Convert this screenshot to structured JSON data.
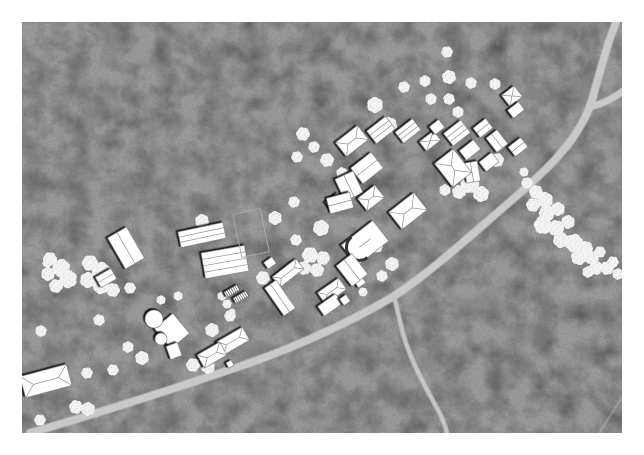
{
  "figure": {
    "kind": "architectural-site-plan",
    "page": {
      "width": 644,
      "height": 455,
      "margin": 22,
      "margin_color": "#ffffff"
    },
    "map": {
      "x": 22,
      "y": 22,
      "width": 600,
      "height": 411,
      "base_color": "#333333",
      "mottle_color": "#6b6b6b"
    }
  },
  "palette": {
    "road": "#c9c9c9",
    "road_spur": "#c6c6c6",
    "path_faint": "#bdbdbd",
    "building_fill": "#ffffff",
    "building_stroke": "#6e6e6e",
    "roof_line": "#8f8f8f",
    "shadow": "#000000",
    "tree_fill": "#f3f3f3",
    "tree_speckle": "#d8d8d8",
    "plot_outline": "#aaaaaa"
  },
  "roads": {
    "main": {
      "d": "M 616,22 C 606,48 600,72 592,100 C 580,140 545,172 505,206 C 468,238 428,274 394,296 C 356,319 300,346 238,367 C 176,388 95,414 30,433",
      "width": 8
    },
    "fork": {
      "d": "M 594,106 C 604,103 614,98 623,91",
      "width": 7
    },
    "spur": {
      "d": "M 394,296 C 399,314 401,332 410,354 C 419,377 432,398 441,416 C 444,423 446,428 447,433",
      "width": 4.5
    },
    "faint": {
      "d": "M 623,396 L 599,433",
      "width": 1.5,
      "opacity": 0.55
    }
  },
  "trees": [
    [
      303,
      134,
      6
    ],
    [
      314,
      147,
      5
    ],
    [
      297,
      157,
      5
    ],
    [
      327,
      160,
      6
    ],
    [
      342,
      173,
      5
    ],
    [
      375,
      105,
      7
    ],
    [
      389,
      125,
      7
    ],
    [
      404,
      87,
      5
    ],
    [
      425,
      81,
      5
    ],
    [
      449,
      77,
      6
    ],
    [
      471,
      83,
      5
    ],
    [
      495,
      84,
      5
    ],
    [
      431,
      99,
      5
    ],
    [
      449,
      99,
      5
    ],
    [
      458,
      112,
      5
    ],
    [
      404,
      135,
      5
    ],
    [
      447,
      52,
      5
    ],
    [
      294,
      202,
      5
    ],
    [
      50,
      259,
      6
    ],
    [
      61,
      268,
      8
    ],
    [
      48,
      274,
      6
    ],
    [
      68,
      279,
      8
    ],
    [
      56,
      286,
      6
    ],
    [
      90,
      263,
      7
    ],
    [
      101,
      271,
      8
    ],
    [
      88,
      280,
      7
    ],
    [
      101,
      286,
      7
    ],
    [
      113,
      290,
      6
    ],
    [
      130,
      288,
      5
    ],
    [
      47,
      263,
      4
    ],
    [
      161,
      300,
      4
    ],
    [
      178,
      296,
      4
    ],
    [
      99,
      320,
      5
    ],
    [
      41,
      331,
      5
    ],
    [
      128,
      347,
      5
    ],
    [
      202,
      221,
      6
    ],
    [
      275,
      218,
      6
    ],
    [
      321,
      228,
      7
    ],
    [
      296,
      240,
      5
    ],
    [
      310,
      255,
      7
    ],
    [
      323,
      258,
      6
    ],
    [
      304,
      268,
      6
    ],
    [
      317,
      270,
      6
    ],
    [
      263,
      278,
      6
    ],
    [
      377,
      247,
      5
    ],
    [
      392,
      264,
      6
    ],
    [
      382,
      276,
      5
    ],
    [
      363,
      292,
      4
    ],
    [
      222,
      296,
      4
    ],
    [
      227,
      304,
      4
    ],
    [
      232,
      312,
      3
    ],
    [
      470,
      184,
      8
    ],
    [
      481,
      194,
      7
    ],
    [
      459,
      192,
      6
    ],
    [
      497,
      160,
      6
    ],
    [
      445,
      190,
      5
    ],
    [
      527,
      183,
      5
    ],
    [
      536,
      192,
      6
    ],
    [
      545,
      200,
      7
    ],
    [
      533,
      205,
      6
    ],
    [
      547,
      213,
      7
    ],
    [
      558,
      209,
      6
    ],
    [
      543,
      225,
      8
    ],
    [
      556,
      228,
      7
    ],
    [
      568,
      222,
      6
    ],
    [
      561,
      240,
      7
    ],
    [
      574,
      243,
      8
    ],
    [
      586,
      248,
      6
    ],
    [
      579,
      257,
      7
    ],
    [
      592,
      258,
      6
    ],
    [
      600,
      252,
      5
    ],
    [
      596,
      268,
      6
    ],
    [
      607,
      268,
      6
    ],
    [
      588,
      272,
      5
    ],
    [
      613,
      262,
      5
    ],
    [
      618,
      274,
      5
    ],
    [
      524,
      172,
      4
    ],
    [
      212,
      330,
      6
    ],
    [
      230,
      316,
      5
    ],
    [
      193,
      365,
      6
    ],
    [
      208,
      367,
      6
    ],
    [
      142,
      358,
      6
    ],
    [
      87,
      373,
      5
    ],
    [
      113,
      370,
      5
    ],
    [
      76,
      407,
      6
    ],
    [
      88,
      409,
      6
    ],
    [
      40,
      420,
      5
    ]
  ],
  "buildings": [
    {
      "x": 126,
      "y": 248,
      "w": 22,
      "h": 36,
      "rot": -30,
      "type": "lines",
      "lines": 1
    },
    {
      "x": 106,
      "y": 278,
      "w": 18,
      "h": 12,
      "rot": -30,
      "type": "lines",
      "lines": 1
    },
    {
      "x": 202,
      "y": 235,
      "w": 46,
      "h": 16,
      "rot": -12,
      "type": "lines",
      "lines": 2
    },
    {
      "x": 225,
      "y": 262,
      "w": 44,
      "h": 26,
      "rot": -10,
      "type": "lines",
      "lines": 3
    },
    {
      "x": 251,
      "y": 233,
      "w": 28,
      "h": 44,
      "rot": -12,
      "type": "outline"
    },
    {
      "x": 232,
      "y": 291,
      "w": 15,
      "h": 6,
      "rot": -30,
      "type": "hatch"
    },
    {
      "x": 241,
      "y": 297,
      "w": 15,
      "h": 6,
      "rot": -30,
      "type": "hatch"
    },
    {
      "x": 270,
      "y": 263,
      "w": 10,
      "h": 8,
      "rot": -35,
      "type": "plain"
    },
    {
      "x": 288,
      "y": 273,
      "w": 30,
      "h": 13,
      "rot": -38,
      "type": "gable"
    },
    {
      "x": 280,
      "y": 298,
      "w": 14,
      "h": 34,
      "rot": -35,
      "type": "lines",
      "lines": 1
    },
    {
      "x": 332,
      "y": 291,
      "w": 26,
      "h": 14,
      "rot": -35,
      "type": "gable"
    },
    {
      "x": 330,
      "y": 305,
      "w": 22,
      "h": 12,
      "rot": -35,
      "type": "plain"
    },
    {
      "x": 345,
      "y": 300,
      "w": 8,
      "h": 8,
      "rot": -35,
      "type": "plain"
    },
    {
      "x": 360,
      "y": 282,
      "w": 9,
      "h": 8,
      "rot": -35,
      "type": "plain"
    },
    {
      "x": 172,
      "y": 331,
      "w": 24,
      "h": 26,
      "rot": -40,
      "type": "plain"
    },
    {
      "x": 174,
      "y": 351,
      "w": 12,
      "h": 14,
      "rot": -20,
      "type": "plain"
    },
    {
      "x": 233,
      "y": 341,
      "w": 30,
      "h": 15,
      "rot": -30,
      "type": "gable"
    },
    {
      "x": 212,
      "y": 355,
      "w": 26,
      "h": 15,
      "rot": -30,
      "type": "gable"
    },
    {
      "x": 230,
      "y": 364,
      "w": 6,
      "h": 6,
      "rot": -30,
      "type": "plain"
    },
    {
      "x": 46,
      "y": 381,
      "w": 48,
      "h": 22,
      "rot": -15,
      "type": "gable"
    },
    {
      "x": 352,
      "y": 141,
      "w": 28,
      "h": 18,
      "rot": -38,
      "type": "gable"
    },
    {
      "x": 381,
      "y": 130,
      "w": 24,
      "h": 16,
      "rot": -38,
      "type": "lines",
      "lines": 2
    },
    {
      "x": 367,
      "y": 168,
      "w": 26,
      "h": 20,
      "rot": -38,
      "type": "lines",
      "lines": 1
    },
    {
      "x": 349,
      "y": 186,
      "w": 20,
      "h": 24,
      "rot": -25,
      "type": "lines",
      "lines": 1
    },
    {
      "x": 335,
      "y": 202,
      "w": 16,
      "h": 12,
      "rot": -38,
      "type": "plain"
    },
    {
      "x": 408,
      "y": 131,
      "w": 22,
      "h": 14,
      "rot": -38,
      "type": "lines",
      "lines": 2
    },
    {
      "x": 430,
      "y": 141,
      "w": 18,
      "h": 12,
      "rot": -38,
      "type": "xroof"
    },
    {
      "x": 437,
      "y": 127,
      "w": 12,
      "h": 10,
      "rot": -38,
      "type": "plain"
    },
    {
      "x": 457,
      "y": 133,
      "w": 22,
      "h": 16,
      "rot": -38,
      "type": "lines",
      "lines": 2
    },
    {
      "x": 470,
      "y": 150,
      "w": 18,
      "h": 12,
      "rot": -38,
      "type": "plain"
    },
    {
      "x": 483,
      "y": 128,
      "w": 16,
      "h": 12,
      "rot": -38,
      "type": "lines",
      "lines": 1
    },
    {
      "x": 497,
      "y": 141,
      "w": 14,
      "h": 18,
      "rot": -38,
      "type": "lines",
      "lines": 1
    },
    {
      "x": 489,
      "y": 162,
      "w": 16,
      "h": 12,
      "rot": -38,
      "type": "plain"
    },
    {
      "x": 472,
      "y": 172,
      "w": 14,
      "h": 20,
      "rot": -10,
      "type": "lines",
      "lines": 1
    },
    {
      "x": 512,
      "y": 96,
      "w": 16,
      "h": 14,
      "rot": -38,
      "type": "xroof"
    },
    {
      "x": 516,
      "y": 110,
      "w": 14,
      "h": 10,
      "rot": -38,
      "type": "plain"
    },
    {
      "x": 518,
      "y": 147,
      "w": 16,
      "h": 12,
      "rot": -38,
      "type": "lines",
      "lines": 1
    },
    {
      "x": 408,
      "y": 211,
      "w": 32,
      "h": 22,
      "rot": -38,
      "type": "gable"
    },
    {
      "x": 371,
      "y": 198,
      "w": 22,
      "h": 16,
      "rot": -38,
      "type": "gable"
    },
    {
      "x": 340,
      "y": 203,
      "w": 24,
      "h": 16,
      "rot": -15,
      "type": "lines",
      "lines": 1
    },
    {
      "x": 365,
      "y": 243,
      "w": 40,
      "h": 26,
      "rot": -38,
      "type": "arc"
    },
    {
      "x": 352,
      "y": 270,
      "w": 20,
      "h": 26,
      "rot": -38,
      "type": "lines",
      "lines": 1
    },
    {
      "x": 453,
      "y": 168,
      "w": 24,
      "h": 30,
      "rot": -38,
      "type": "gable"
    }
  ],
  "tower_building": {
    "big_circle": [
      154,
      319,
      9
    ],
    "small_circle": [
      161,
      339,
      6
    ]
  }
}
